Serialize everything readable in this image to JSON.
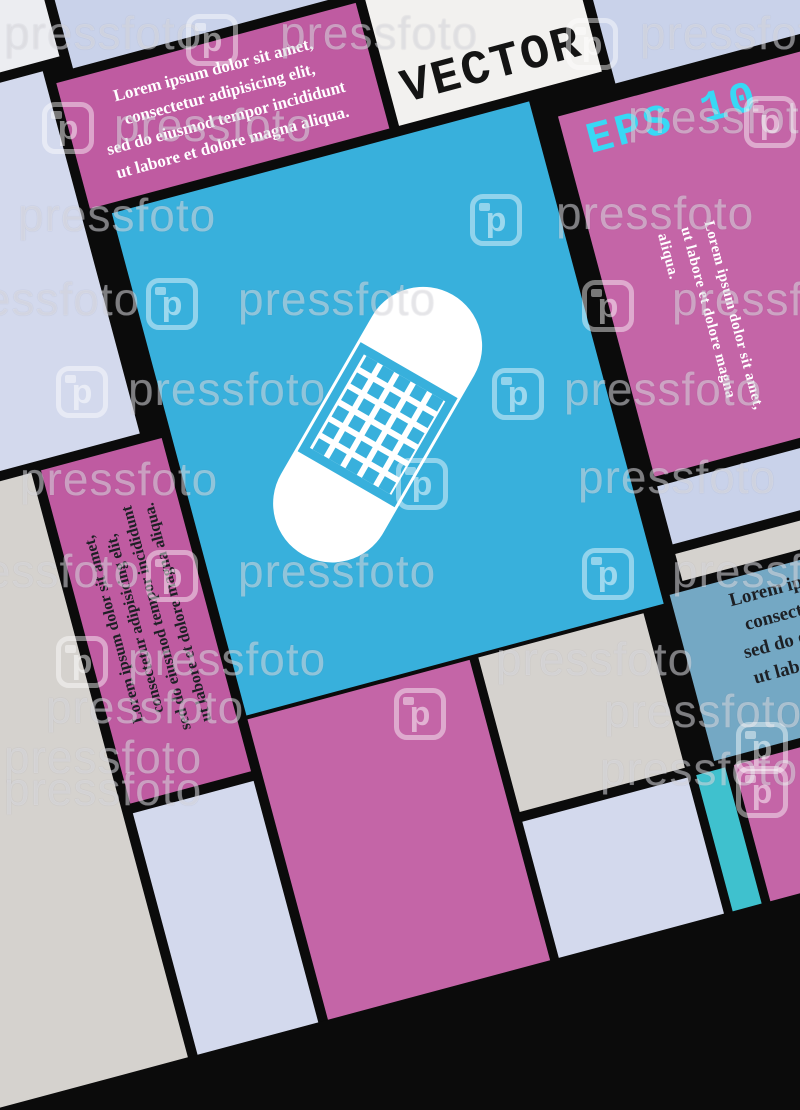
{
  "palette": {
    "corner-light": "#ecedf1",
    "lavender-a": "#d3d9ed",
    "lavender-b": "#c9d2ea",
    "warm-gray": "#d5d2ce",
    "pink": "#c465a7",
    "pink-deep": "#bf5ba1",
    "white-tile": "#f2f1ef",
    "blue": "#38b0dc",
    "steel": "#74a8c4",
    "teal": "#3fc1ce",
    "border-black": "#0b0b0b",
    "cyan-label": "#38d8f5",
    "dark-text": "#1d2025",
    "white-text": "#ffffff"
  },
  "labels": {
    "vector": "VECTOR",
    "eps": "EPS 10"
  },
  "texts": {
    "lorem_lines": [
      "Lorem ipsum dolor sit amet,",
      "consectetur adipisicing elit,",
      "sed do eiusmod tempor incididunt",
      "ut labore et dolore magna aliqua."
    ],
    "lorem_right_lines": [
      "Lorem ipsum dolor sit amet,",
      "ut labore et dolore magna aliqua."
    ],
    "lorem_clipped_lines": [
      "Lorem ipsum d",
      "consectetur a",
      "sed do eiusmod",
      "ut labore et do"
    ]
  },
  "icon": {
    "name": "band-aid plaster icon",
    "pad_grid_cols": 6,
    "pad_grid_rows": 5
  },
  "watermark": {
    "label": "pressfoto",
    "logo_letter": "p",
    "items": [
      {
        "t": "text",
        "x": 4,
        "y": 6
      },
      {
        "t": "logo",
        "x": 186,
        "y": 14
      },
      {
        "t": "text",
        "x": 280,
        "y": 6
      },
      {
        "t": "logo",
        "x": 566,
        "y": 18
      },
      {
        "t": "text",
        "x": 640,
        "y": 6
      },
      {
        "t": "logo",
        "x": 42,
        "y": 102
      },
      {
        "t": "text",
        "x": 114,
        "y": 98
      },
      {
        "t": "text",
        "x": 628,
        "y": 90
      },
      {
        "t": "logo",
        "x": 744,
        "y": 96
      },
      {
        "t": "text",
        "x": 18,
        "y": 188
      },
      {
        "t": "logo",
        "x": 470,
        "y": 194
      },
      {
        "t": "text",
        "x": 556,
        "y": 186
      },
      {
        "t": "text",
        "x": -58,
        "y": 272
      },
      {
        "t": "logo",
        "x": 146,
        "y": 278
      },
      {
        "t": "text",
        "x": 238,
        "y": 272
      },
      {
        "t": "logo",
        "x": 582,
        "y": 280
      },
      {
        "t": "text",
        "x": 672,
        "y": 272
      },
      {
        "t": "logo",
        "x": 56,
        "y": 366
      },
      {
        "t": "text",
        "x": 128,
        "y": 362
      },
      {
        "t": "logo",
        "x": 492,
        "y": 368
      },
      {
        "t": "text",
        "x": 564,
        "y": 362
      },
      {
        "t": "text",
        "x": 20,
        "y": 452
      },
      {
        "t": "logo",
        "x": 396,
        "y": 458
      },
      {
        "t": "text",
        "x": 578,
        "y": 450
      },
      {
        "t": "text",
        "x": -58,
        "y": 544
      },
      {
        "t": "logo",
        "x": 146,
        "y": 550
      },
      {
        "t": "text",
        "x": 238,
        "y": 544
      },
      {
        "t": "logo",
        "x": 582,
        "y": 548
      },
      {
        "t": "text",
        "x": 672,
        "y": 544
      },
      {
        "t": "logo",
        "x": 56,
        "y": 636
      },
      {
        "t": "text",
        "x": 128,
        "y": 632
      },
      {
        "t": "text",
        "x": 496,
        "y": 632
      },
      {
        "t": "text",
        "x": 46,
        "y": 680
      },
      {
        "t": "logo",
        "x": 394,
        "y": 688
      },
      {
        "t": "text",
        "x": 604,
        "y": 684
      },
      {
        "t": "text",
        "x": 4,
        "y": 730
      },
      {
        "t": "text",
        "x": 4,
        "y": 762
      },
      {
        "t": "text",
        "x": 600,
        "y": 742
      },
      {
        "t": "logo",
        "x": 736,
        "y": 722
      },
      {
        "t": "logo",
        "x": 736,
        "y": 766
      }
    ]
  }
}
